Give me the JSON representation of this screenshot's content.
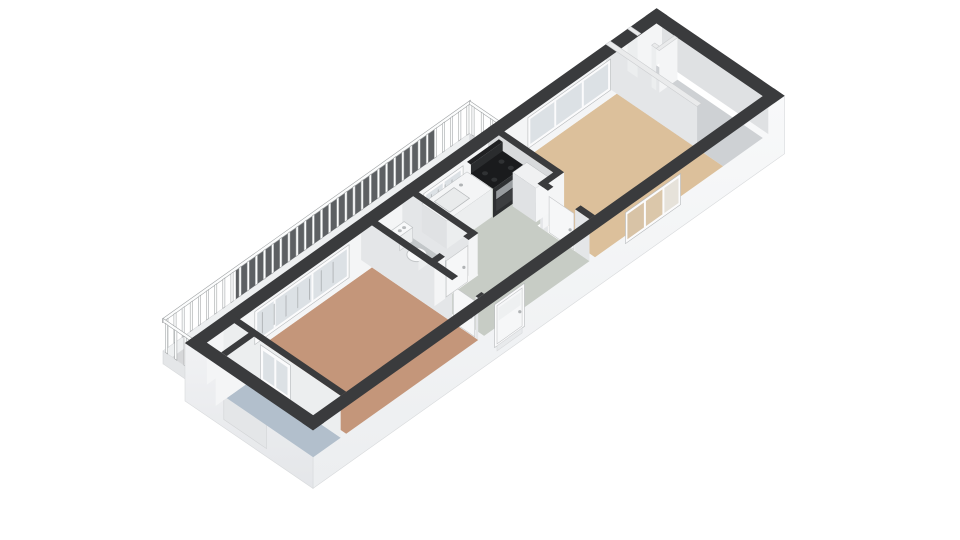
{
  "scene": {
    "kind": "floorplan-3d-render",
    "background": "#ffffff"
  },
  "rooms": {
    "gallery-balcony": "#d6d7d9",
    "loggia": "#b2bfcc",
    "bedroom": "#c4967a",
    "toilet": "#c3c7c9",
    "hall-kitchen": "#c7ccc5",
    "living-room": "#dcc09b",
    "storage-room": "#ced1d4"
  },
  "palette": {
    "wall_top_dark": "#3a3b3d",
    "wall_top_light": "#eaebec",
    "wall_top_light_stroke": "#cdcfd1",
    "face_bright": "#f4f5f6",
    "face_light": "#eceeef",
    "face_mid": "#e4e6e8",
    "face_shaded": "#dfe1e3",
    "face_dark": "#d8dadc",
    "fascia_front_top": "#f8f9fa",
    "fascia_front_bottom": "#eceef0",
    "fascia_end_top": "#f1f2f4",
    "fascia_end_bottom": "#e4e6e9",
    "fascia_edge": "#d8dadc",
    "balcony_inner_shadow": "#c6c8ca",
    "balcony_fascia": "#eef0f1",
    "railing_backdrop": "#5d6063",
    "railing_white": "#fcfdfd",
    "railing_stroke": "#9fa2a4",
    "glass": "#dce1e5",
    "glass_line": "#b3b7ba",
    "pane_tint_a": "#d8c3a6",
    "pane_tint_b": "#dbc7aa",
    "pane_tint_c": "#e6e2da",
    "frame_white": "#fbfbfc",
    "frame_stroke": "#b6b9bb",
    "counter_top": "#f4f5f6",
    "counter_front": "#eceeef",
    "counter_side": "#e0e2e4",
    "sink_fill": "#e9ebec",
    "stove_top": "#1a1b1d",
    "stove_front": "#2e3032",
    "stove_steel": "#989c9f",
    "stove_glass": "#3c3e40",
    "burner": "#303234",
    "toilet_white": "#f8f9fa",
    "toilet_shade": "#eceeef",
    "toilet_stroke": "#c3c6c8",
    "button_gray": "#b7babc",
    "door_leaf": "#f6f7f8",
    "door_stroke": "#c5c7c9",
    "handle_gray": "#b0b3b5"
  },
  "railing": {
    "baluster_count": 38,
    "return_baluster_count": 4
  },
  "windows": [
    "bedroom-window",
    "kitchen-window",
    "living-room-window",
    "rear-window"
  ],
  "doors": [
    "balcony-door",
    "bedroom-door",
    "toilet-door",
    "living-room-door",
    "entry-door"
  ],
  "fixtures": [
    "toilet",
    "kitchen-counter",
    "sink",
    "stove",
    "tall-cabinet"
  ]
}
